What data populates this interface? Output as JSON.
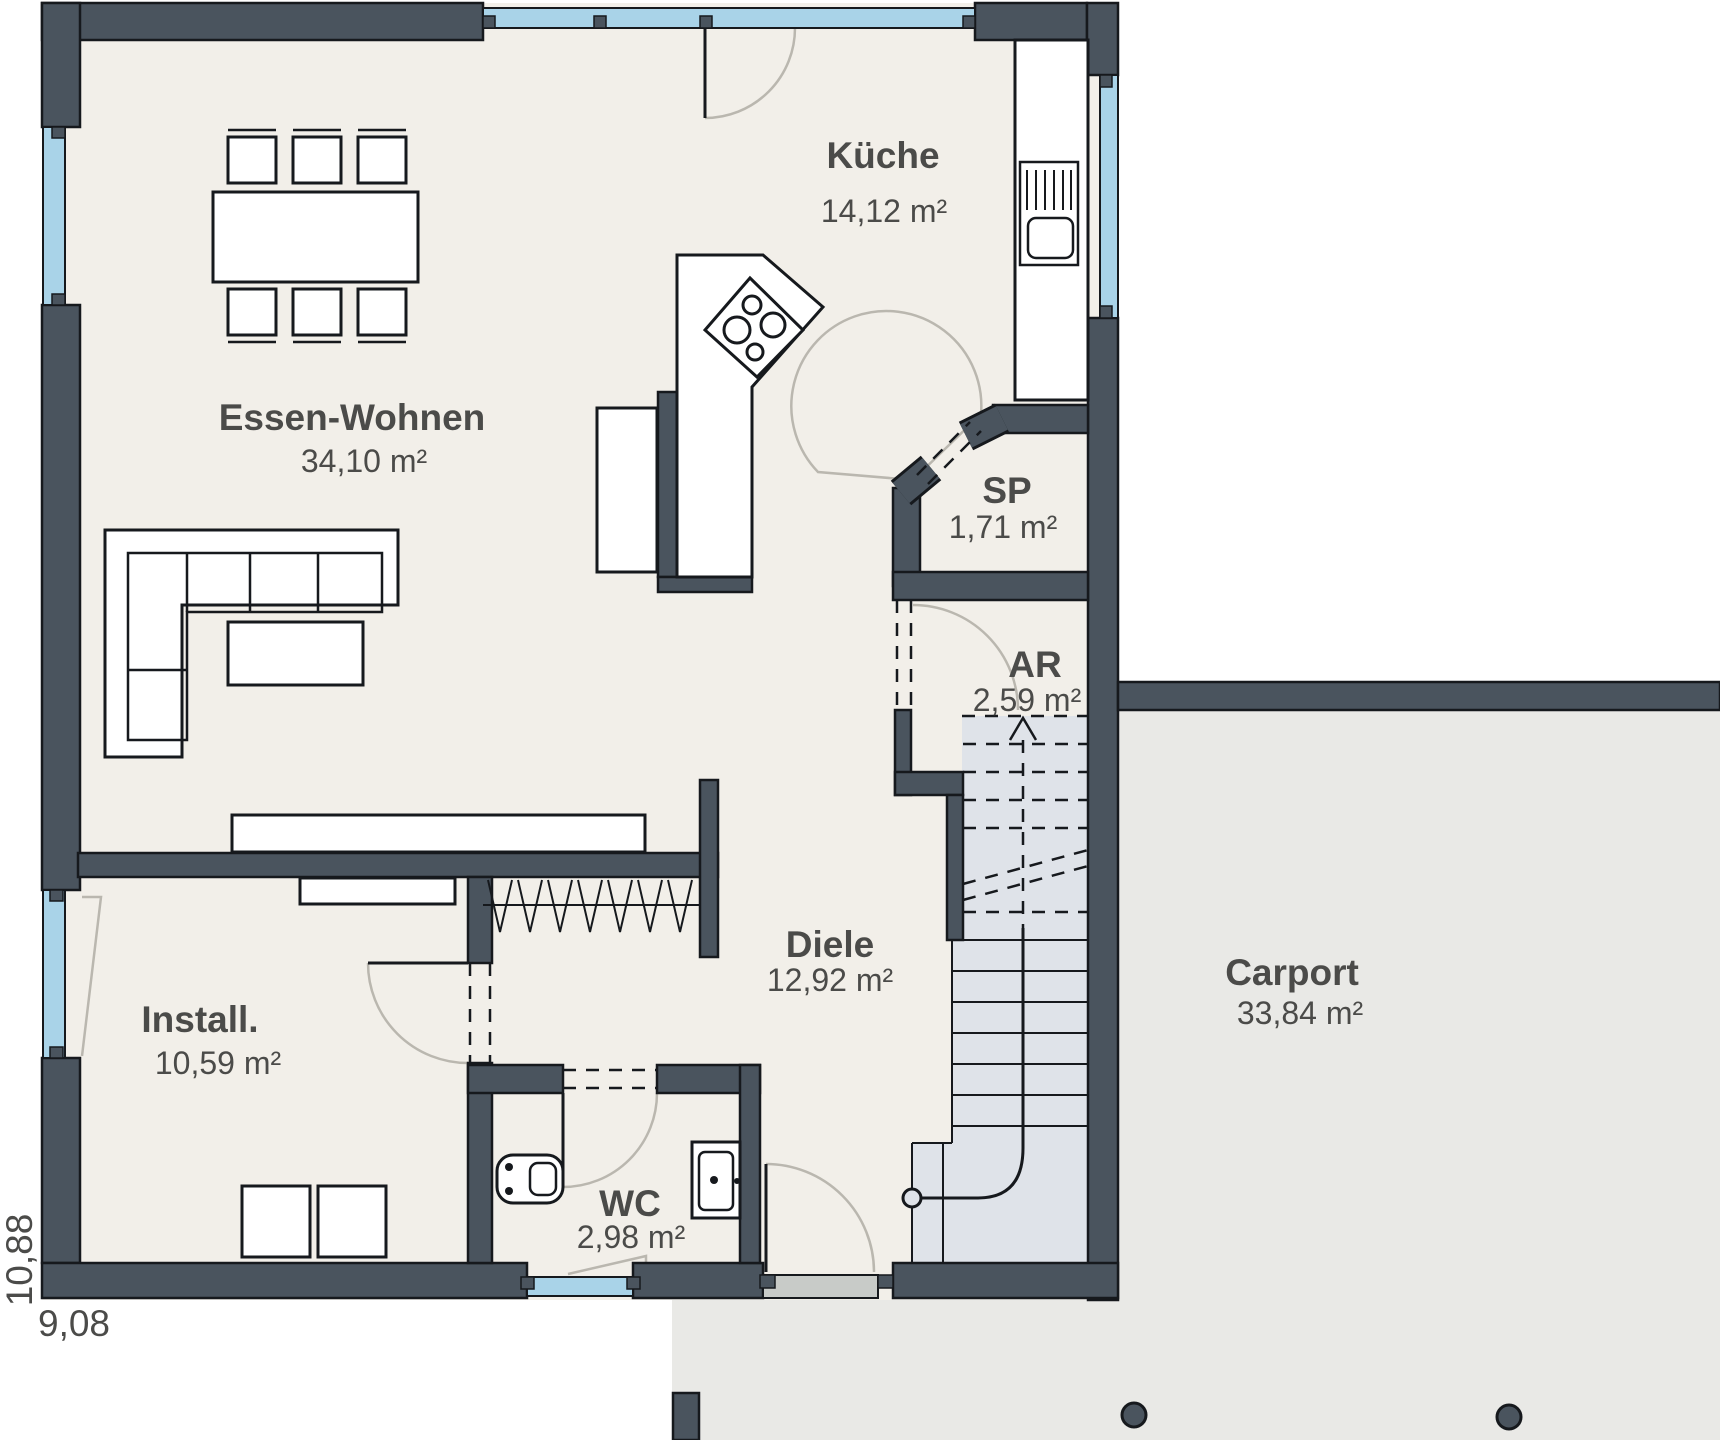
{
  "rooms": [
    {
      "id": "kueche",
      "name": "Küche",
      "area": "14,12 m²"
    },
    {
      "id": "essen-wohnen",
      "name": "Essen-Wohnen",
      "area": "34,10 m²"
    },
    {
      "id": "sp",
      "name": "SP",
      "area": "1,71 m²"
    },
    {
      "id": "ar",
      "name": "AR",
      "area": "2,59 m²"
    },
    {
      "id": "diele",
      "name": "Diele",
      "area": "12,92 m²"
    },
    {
      "id": "install",
      "name": "Install.",
      "area": "10,59 m²"
    },
    {
      "id": "wc",
      "name": "WC",
      "area": "2,98 m²"
    },
    {
      "id": "carport",
      "name": "Carport",
      "area": "33,84 m²"
    }
  ],
  "dimensions": {
    "width": "9,08",
    "height": "10,88"
  },
  "colors": {
    "wall": "#4a545e",
    "wall_outline": "#16191d",
    "window_glass": "#a9d3e8",
    "floor": "#f2efe9",
    "stair_floor": "#dfe3e9",
    "carport_floor": "#e9e9e6",
    "entry_sill": "#c8cbc8",
    "door_swing": "#bab7af",
    "text": "#4b4b49"
  }
}
